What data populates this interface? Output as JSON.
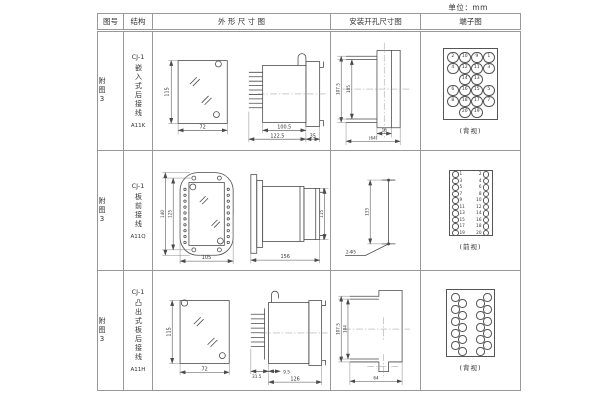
{
  "unit_label": "单位：mm",
  "headers": {
    "fig": "图号",
    "structure": "结构",
    "outline": "外 形 尺 寸 图",
    "mounting": "安装开孔尺寸图",
    "terminal": "端子图"
  },
  "rows": [
    {
      "fig": "附图3",
      "series": "CJ-1",
      "structure": "嵌入式后接线",
      "code": "A11K",
      "outline": {
        "h": "115",
        "w": "72",
        "body": "100.5",
        "total": "122.5",
        "flange": "35"
      },
      "mounting": {
        "outer_h": "107.5",
        "inner_h": "105",
        "slot_w": "16",
        "outer_w": "(64)"
      },
      "terminal": {
        "label": "(背视)",
        "grid": [
          [
            "2",
            "10",
            "9",
            "1"
          ],
          [
            "4",
            "12",
            "11",
            "3"
          ],
          [
            "14",
            "13"
          ],
          [
            "6",
            "16",
            "15",
            "5"
          ],
          [
            "8",
            "18",
            "17",
            "7"
          ],
          [
            "20",
            "19"
          ]
        ]
      }
    },
    {
      "fig": "附图3",
      "series": "CJ-1",
      "structure": "板前接线",
      "code": "A11Q",
      "outline": {
        "h_outer": "140",
        "h_inner": "125",
        "w": "105",
        "depth": "156",
        "side_h": "115"
      },
      "mounting": {
        "hole_dist": "133",
        "hole_label": "2-Φ5"
      },
      "terminal": {
        "label": "(前视)",
        "left": [
          "1",
          "3",
          "5",
          "7",
          "9",
          "11",
          "13",
          "15",
          "17",
          "19"
        ],
        "right": [
          "2",
          "4",
          "6",
          "8",
          "10",
          "12",
          "14",
          "16",
          "18",
          "20"
        ]
      }
    },
    {
      "fig": "附图3",
      "series": "CJ-1",
      "structure": "凸出式板后接线",
      "code": "A11H",
      "outline": {
        "h": "115",
        "w": "72",
        "pin_l": "31.5",
        "gap": "9.5",
        "body_l": "126"
      },
      "mounting": {
        "outer_h": "107.5",
        "inner_h": "104",
        "outer_w": "64"
      },
      "terminal": {
        "label": "(背视)"
      }
    }
  ]
}
